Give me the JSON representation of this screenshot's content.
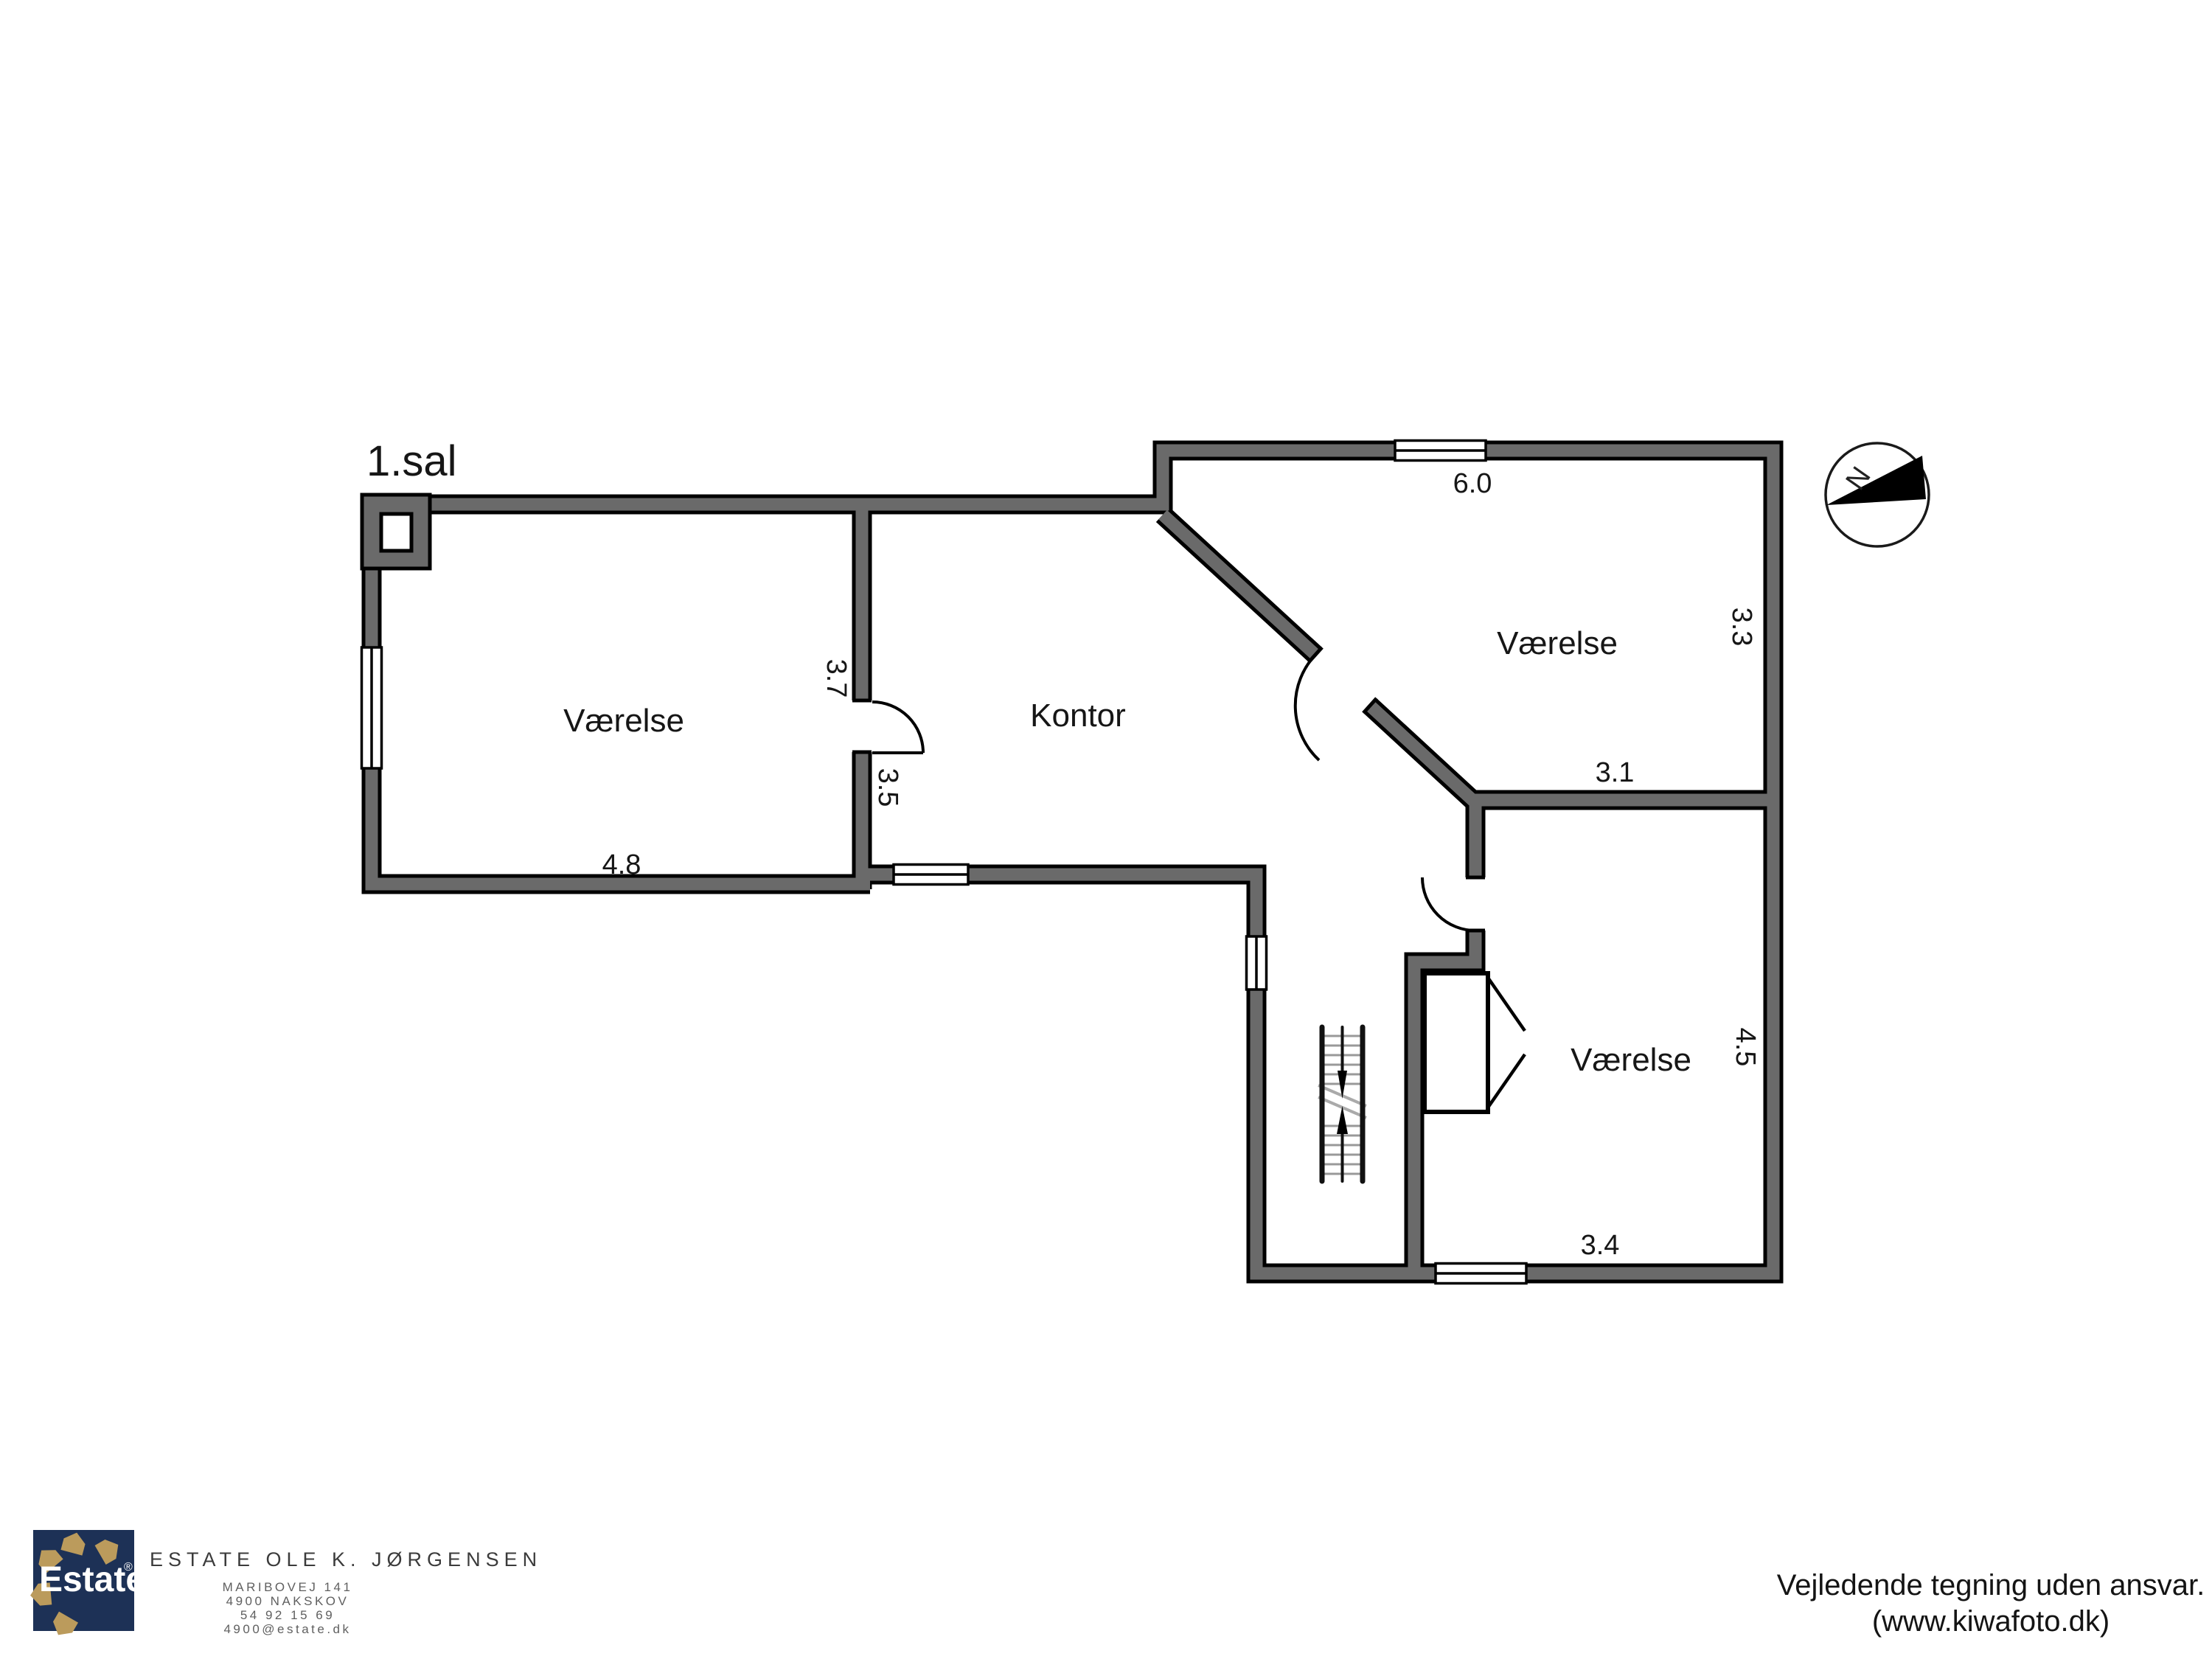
{
  "plan": {
    "title": "1.sal",
    "rooms": {
      "room_left": "Værelse",
      "room_office": "Kontor",
      "room_top_right": "Værelse",
      "room_bottom_right": "Værelse"
    },
    "dimensions": {
      "left_room_width": "4.8",
      "left_room_wall_upper": "3.7",
      "left_room_wall_lower": "3.5",
      "top_room_width": "6.0",
      "top_room_right_wall": "3.3",
      "top_room_bottom": "3.1",
      "bottom_room_right_wall": "4.5",
      "bottom_room_width": "3.4"
    },
    "compass": {
      "north_label": "N"
    },
    "colors": {
      "wall_fill": "#6a6a6a",
      "wall_outline": "#000000",
      "background": "#ffffff"
    }
  },
  "footer": {
    "logo": {
      "brand": "Estate",
      "registered_mark": "®",
      "navy": "#1d3156",
      "gold": "#bb9b5c"
    },
    "agency": {
      "name": "ESTATE OLE K. JØRGENSEN",
      "address_line1": "MARIBOVEJ 141",
      "address_line2": "4900 NAKSKOV",
      "address_line3": "54 92 15 69",
      "address_line4": "4900@estate.dk"
    },
    "disclaimer": {
      "line1": "Vejledende tegning uden ansvar.",
      "line2": "(www.kiwafoto.dk)"
    }
  }
}
